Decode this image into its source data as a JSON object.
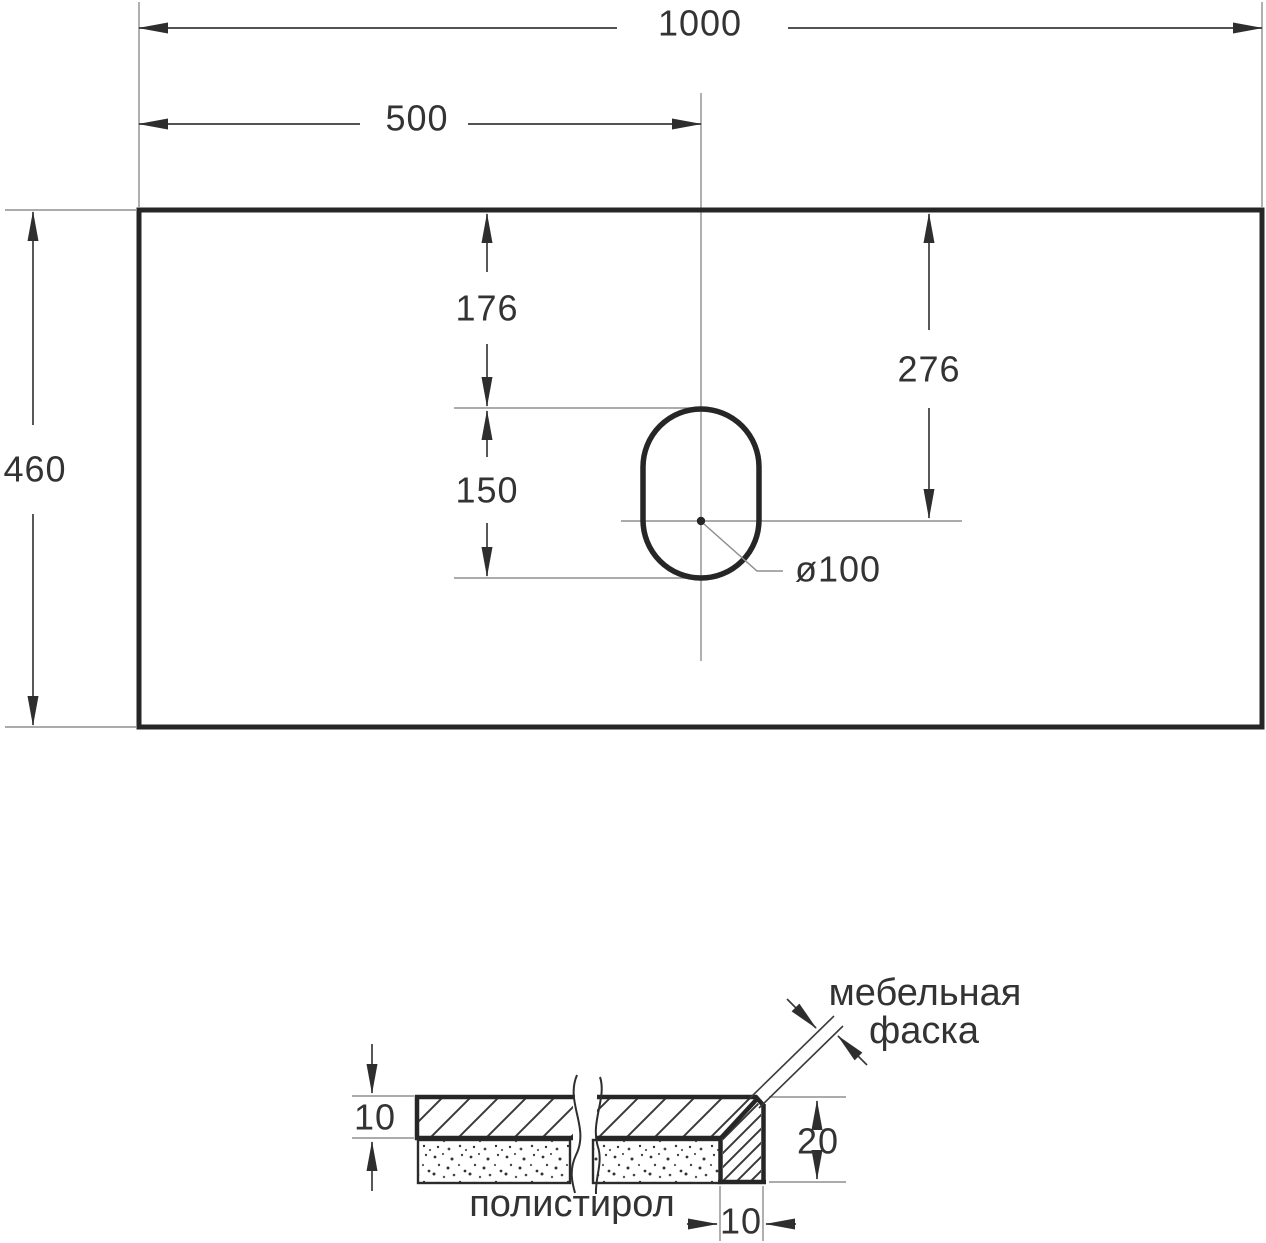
{
  "top_view": {
    "dim_width": "1000",
    "dim_center_offset": "500",
    "dim_depth": "460",
    "dim_hole_top_offset": "176",
    "dim_hole_length": "150",
    "dim_hole_center_offset": "276",
    "dim_hole_diameter": "ø100"
  },
  "section_view": {
    "dim_top_thickness": "10",
    "dim_edge_height": "20",
    "dim_edge_width": "10",
    "label_chamfer_line1": "мебельная",
    "label_chamfer_line2": "фаска",
    "label_filler": "полистирол"
  },
  "colors": {
    "background": "#ffffff",
    "object_line": "#262626",
    "dimension_line": "#3a3a3a",
    "extension_line": "#8f8f8f",
    "text": "#333333"
  }
}
